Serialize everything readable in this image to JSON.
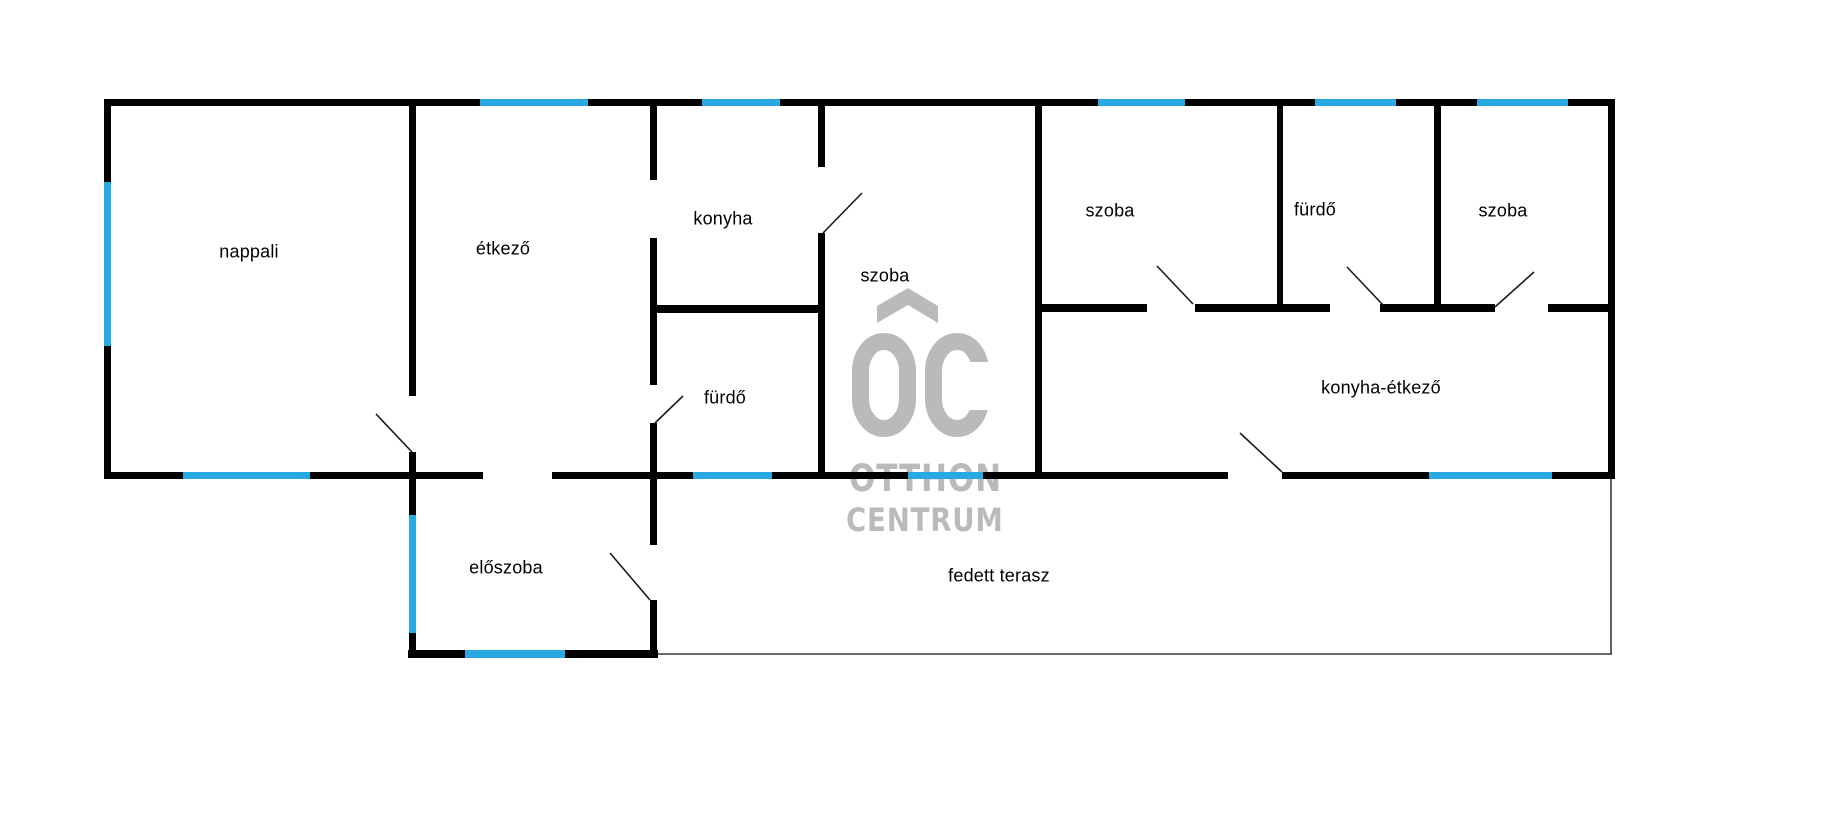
{
  "canvas": {
    "width": 1825,
    "height": 816,
    "background": "#ffffff"
  },
  "colors": {
    "wall": "#010101",
    "window": "#29a9e1",
    "label": "#000000",
    "door_line": "#1a1a1a",
    "terrace_line": "#3a3a3a",
    "watermark": "#b9babc"
  },
  "watermark": {
    "monogram": "OC",
    "brand_top": "OTTHON",
    "brand_bottom": "CENTRUM"
  },
  "rooms": [
    {
      "label": "nappali",
      "x": 249,
      "y": 252
    },
    {
      "label": "étkező",
      "x": 503,
      "y": 249
    },
    {
      "label": "konyha",
      "x": 723,
      "y": 219
    },
    {
      "label": "szoba",
      "x": 885,
      "y": 276
    },
    {
      "label": "fürdő",
      "x": 725,
      "y": 398
    },
    {
      "label": "szoba",
      "x": 1110,
      "y": 211
    },
    {
      "label": "fürdő",
      "x": 1315,
      "y": 210
    },
    {
      "label": "szoba",
      "x": 1503,
      "y": 211
    },
    {
      "label": "konyha-étkező",
      "x": 1381,
      "y": 388
    },
    {
      "label": "előszoba",
      "x": 506,
      "y": 568
    },
    {
      "label": "fedett terasz",
      "x": 999,
      "y": 576
    }
  ],
  "walls": [
    {
      "x": 104,
      "y": 99,
      "w": 1511,
      "h": 7
    },
    {
      "x": 650,
      "y": 305,
      "w": 175,
      "h": 8
    },
    {
      "x": 1035,
      "y": 304,
      "w": 112,
      "h": 8
    },
    {
      "x": 1195,
      "y": 304,
      "w": 135,
      "h": 8
    },
    {
      "x": 1380,
      "y": 304,
      "w": 115,
      "h": 8
    },
    {
      "x": 1548,
      "y": 304,
      "w": 62,
      "h": 8
    },
    {
      "x": 104,
      "y": 472,
      "w": 379,
      "h": 7
    },
    {
      "x": 552,
      "y": 472,
      "w": 676,
      "h": 7
    },
    {
      "x": 1282,
      "y": 472,
      "w": 333,
      "h": 7
    },
    {
      "x": 408,
      "y": 650,
      "w": 250,
      "h": 8
    },
    {
      "x": 104,
      "y": 99,
      "w": 7,
      "h": 380
    },
    {
      "x": 409,
      "y": 99,
      "w": 7,
      "h": 297
    },
    {
      "x": 409,
      "y": 452,
      "w": 7,
      "h": 206
    },
    {
      "x": 650,
      "y": 99,
      "w": 7,
      "h": 81
    },
    {
      "x": 650,
      "y": 238,
      "w": 7,
      "h": 147
    },
    {
      "x": 650,
      "y": 423,
      "w": 7,
      "h": 122
    },
    {
      "x": 650,
      "y": 600,
      "w": 7,
      "h": 58
    },
    {
      "x": 818,
      "y": 99,
      "w": 7,
      "h": 68
    },
    {
      "x": 818,
      "y": 233,
      "w": 7,
      "h": 246
    },
    {
      "x": 1035,
      "y": 99,
      "w": 7,
      "h": 380
    },
    {
      "x": 1277,
      "y": 99,
      "w": 6,
      "h": 205
    },
    {
      "x": 1434,
      "y": 99,
      "w": 7,
      "h": 205
    },
    {
      "x": 1608,
      "y": 99,
      "w": 7,
      "h": 380
    }
  ],
  "windows": [
    {
      "x": 480,
      "y": 99,
      "w": 108,
      "h": 7
    },
    {
      "x": 702,
      "y": 99,
      "w": 78,
      "h": 7
    },
    {
      "x": 1098,
      "y": 99,
      "w": 87,
      "h": 7
    },
    {
      "x": 1315,
      "y": 99,
      "w": 81,
      "h": 7
    },
    {
      "x": 1477,
      "y": 99,
      "w": 91,
      "h": 7
    },
    {
      "x": 104,
      "y": 182,
      "w": 7,
      "h": 164
    },
    {
      "x": 183,
      "y": 472,
      "w": 127,
      "h": 7
    },
    {
      "x": 693,
      "y": 472,
      "w": 79,
      "h": 7
    },
    {
      "x": 908,
      "y": 472,
      "w": 75,
      "h": 7
    },
    {
      "x": 1429,
      "y": 472,
      "w": 123,
      "h": 7
    },
    {
      "x": 409,
      "y": 515,
      "w": 7,
      "h": 118
    },
    {
      "x": 465,
      "y": 650,
      "w": 100,
      "h": 8
    }
  ],
  "doors": [
    {
      "x1": 412,
      "y1": 452,
      "x2": 376,
      "y2": 414
    },
    {
      "x1": 823,
      "y1": 233,
      "x2": 862,
      "y2": 193
    },
    {
      "x1": 655,
      "y1": 423,
      "x2": 683,
      "y2": 396
    },
    {
      "x1": 650,
      "y1": 600,
      "x2": 610,
      "y2": 553
    },
    {
      "x1": 1282,
      "y1": 472,
      "x2": 1240,
      "y2": 433
    },
    {
      "x1": 1193,
      "y1": 304,
      "x2": 1157,
      "y2": 266
    },
    {
      "x1": 1383,
      "y1": 305,
      "x2": 1347,
      "y2": 267
    },
    {
      "x1": 1495,
      "y1": 307,
      "x2": 1534,
      "y2": 272
    }
  ],
  "terrace_outline": [
    {
      "x1": 658,
      "y1": 654,
      "x2": 1612,
      "y2": 654
    },
    {
      "x1": 1611,
      "y1": 479,
      "x2": 1611,
      "y2": 654
    }
  ]
}
